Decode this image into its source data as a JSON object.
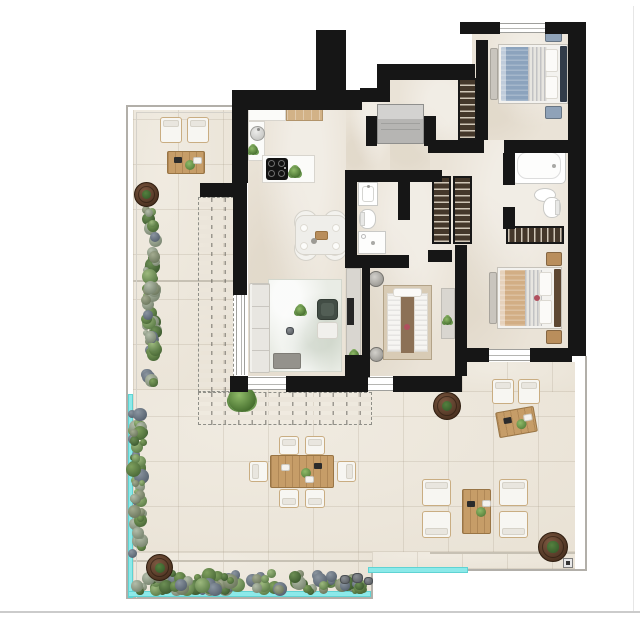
{
  "meta": {
    "type": "architectural-floor-plan",
    "description": "Rendered top-view floor plan of a three-bedroom apartment with two bathrooms, open kitchen-living area, wrap-around west and south terrace with pergola, hedges, planters, outdoor dining and lounge furniture, and a glass balustrade."
  },
  "palette": {
    "wall": "#161616",
    "interior_floor": "#eae3d7",
    "terrace_floor": "#ece6da",
    "glass_balustrade": "#8ce9e9",
    "wood": "#c69d68",
    "hedge_green": "#6d8f55",
    "planter_brown": "#5d4028",
    "duvet_blue": "#8ca3bd",
    "duvet_tan": "#d2ae85",
    "property_line": "#b2afa9"
  },
  "scene": [
    {
      "n": "terrace-floor-west",
      "t": "tfloor",
      "x": 133,
      "y": 110,
      "w": 100,
      "h": 280
    },
    {
      "n": "terrace-floor-south",
      "t": "tfloor",
      "x": 133,
      "y": 390,
      "w": 442,
      "h": 162
    },
    {
      "n": "terrace-floor-south-deep",
      "t": "tfloor",
      "x": 133,
      "y": 552,
      "w": 239,
      "h": 46
    },
    {
      "n": "terrace-floor-south-right",
      "t": "tfloor",
      "x": 372,
      "y": 552,
      "w": 203,
      "h": 17
    },
    {
      "n": "terrace-floor-east-gap",
      "t": "tfloor",
      "x": 462,
      "y": 362,
      "w": 113,
      "h": 30
    },
    {
      "n": "floor-kitchen-living",
      "t": "ifloor",
      "x": 248,
      "y": 92,
      "w": 98,
      "h": 284
    },
    {
      "n": "floor-hall-west",
      "t": "ifloor",
      "x": 346,
      "y": 100,
      "w": 44,
      "h": 76
    },
    {
      "n": "floor-hall-east",
      "t": "ifloor",
      "x": 390,
      "y": 80,
      "w": 86,
      "h": 96
    },
    {
      "n": "floor-bedroom1",
      "t": "ifloor",
      "x": 472,
      "y": 33,
      "w": 98,
      "h": 107
    },
    {
      "n": "floor-east-wing",
      "t": "ifloor",
      "x": 430,
      "y": 140,
      "w": 140,
      "h": 216
    },
    {
      "n": "floor-center-wing",
      "t": "ifloor",
      "x": 345,
      "y": 170,
      "w": 110,
      "h": 206
    },
    {
      "n": "floor-joint",
      "t": "jline",
      "x": 133,
      "y": 280,
      "w": 100,
      "h": 2
    },
    {
      "n": "floor-joint",
      "t": "jline",
      "x": 133,
      "y": 560,
      "w": 239,
      "h": 2
    },
    {
      "n": "floor-joint",
      "t": "jline",
      "x": 430,
      "y": 552,
      "w": 145,
      "h": 2
    },
    {
      "n": "pergola-west",
      "t": "pergola",
      "x": 198,
      "y": 197,
      "w": 36,
      "h": 195
    },
    {
      "n": "pergola-south",
      "t": "pergola",
      "x": 198,
      "y": 392,
      "w": 174,
      "h": 33
    },
    {
      "n": "grass-tuft",
      "t": "plant",
      "x": 228,
      "y": 386,
      "w": 28,
      "h": 26
    },
    {
      "n": "property-line-west",
      "t": "pline",
      "x": 126,
      "y": 105,
      "w": 2,
      "h": 494
    },
    {
      "n": "property-line-north",
      "t": "pline",
      "x": 126,
      "y": 105,
      "w": 107,
      "h": 2
    },
    {
      "n": "property-line-south",
      "t": "pline",
      "x": 126,
      "y": 597,
      "w": 246,
      "h": 2
    },
    {
      "n": "property-line-step",
      "t": "pline",
      "x": 371,
      "y": 569,
      "w": 2,
      "h": 30
    },
    {
      "n": "property-line-south-right",
      "t": "pline",
      "x": 371,
      "y": 569,
      "w": 216,
      "h": 2
    },
    {
      "n": "property-line-east",
      "t": "pline",
      "x": 585,
      "y": 356,
      "w": 2,
      "h": 215
    },
    {
      "n": "property-line-inner-west",
      "t": "pline4",
      "x": 136,
      "y": 112,
      "w": 1,
      "h": 486
    },
    {
      "n": "property-line-inner-north",
      "t": "pline4",
      "x": 136,
      "y": 112,
      "w": 97,
      "h": 1
    },
    {
      "n": "site-line-bottom",
      "t": "pline2",
      "x": 0,
      "y": 611,
      "w": 640,
      "h": 2
    },
    {
      "n": "site-line-right",
      "t": "pline3",
      "x": 633,
      "y": 6,
      "w": 1,
      "h": 605
    },
    {
      "n": "glass-balustrade-west",
      "t": "glass",
      "x": 128,
      "y": 394,
      "w": 5,
      "h": 204
    },
    {
      "n": "glass-balustrade-south",
      "t": "glass",
      "x": 128,
      "y": 591,
      "w": 243,
      "h": 6
    },
    {
      "n": "glass-balustrade-south-right",
      "t": "glass",
      "x": 368,
      "y": 567,
      "w": 100,
      "h": 6
    },
    {
      "n": "survey-marker",
      "t": "marker",
      "x": 563,
      "y": 558,
      "w": 10,
      "h": 10
    },
    {
      "n": "hedge-west-upper",
      "t": "hedge",
      "x": 143,
      "y": 206,
      "w": 17,
      "h": 184
    },
    {
      "n": "hedge-west-lower",
      "t": "hedge",
      "x": 129,
      "y": 410,
      "w": 17,
      "h": 148
    },
    {
      "n": "hedge-south",
      "t": "hedge",
      "x": 133,
      "y": 571,
      "w": 238,
      "h": 23
    },
    {
      "n": "planter-nw",
      "t": "planter",
      "x": 134,
      "y": 182,
      "w": 25,
      "h": 25
    },
    {
      "n": "planter-center",
      "t": "planter",
      "x": 433,
      "y": 392,
      "w": 28,
      "h": 28
    },
    {
      "n": "planter-se",
      "t": "planter",
      "x": 538,
      "y": 532,
      "w": 30,
      "h": 30
    },
    {
      "n": "planter-sw",
      "t": "planter",
      "x": 146,
      "y": 554,
      "w": 27,
      "h": 27
    },
    {
      "n": "rock",
      "t": "rock",
      "x": 340,
      "y": 575,
      "w": 10,
      "h": 9
    },
    {
      "n": "rock",
      "t": "rock",
      "x": 352,
      "y": 573,
      "w": 11,
      "h": 10
    },
    {
      "n": "rock",
      "t": "rock",
      "x": 364,
      "y": 577,
      "w": 9,
      "h": 8
    },
    {
      "n": "lounge-chair",
      "t": "chairo",
      "x": 160,
      "y": 117,
      "w": 22,
      "h": 26,
      "b": "n"
    },
    {
      "n": "lounge-chair",
      "t": "chairo",
      "x": 187,
      "y": 117,
      "w": 22,
      "h": 26,
      "b": "n"
    },
    {
      "n": "coffee-table",
      "t": "twood",
      "x": 167,
      "y": 151,
      "w": 38,
      "h": 23,
      "d": [
        "trayb",
        "plant",
        "trayw"
      ]
    },
    {
      "n": "outdoor-dining-chair",
      "t": "chairo",
      "x": 279,
      "y": 436,
      "w": 20,
      "h": 19,
      "b": "n"
    },
    {
      "n": "outdoor-dining-chair",
      "t": "chairo",
      "x": 305,
      "y": 436,
      "w": 20,
      "h": 19,
      "b": "n"
    },
    {
      "n": "outdoor-dining-chair",
      "t": "chairo",
      "x": 279,
      "y": 489,
      "w": 20,
      "h": 19,
      "b": "s"
    },
    {
      "n": "outdoor-dining-chair",
      "t": "chairo",
      "x": 305,
      "y": 489,
      "w": 20,
      "h": 19,
      "b": "s"
    },
    {
      "n": "outdoor-dining-chair",
      "t": "chairo",
      "x": 249,
      "y": 461,
      "w": 19,
      "h": 21,
      "b": "w"
    },
    {
      "n": "outdoor-dining-chair",
      "t": "chairo",
      "x": 337,
      "y": 461,
      "w": 19,
      "h": 21,
      "b": "e"
    },
    {
      "n": "outdoor-dining-table",
      "t": "twood",
      "x": 270,
      "y": 455,
      "w": 64,
      "h": 33,
      "d": [
        "trayw",
        "plant",
        "trayb",
        "trayw2"
      ]
    },
    {
      "n": "lounge-armchair",
      "t": "chairo",
      "x": 422,
      "y": 479,
      "w": 29,
      "h": 27,
      "b": "n"
    },
    {
      "n": "lounge-armchair",
      "t": "chairo",
      "x": 499,
      "y": 479,
      "w": 29,
      "h": 27,
      "b": "n"
    },
    {
      "n": "lounge-armchair",
      "t": "chairo",
      "x": 422,
      "y": 511,
      "w": 29,
      "h": 27,
      "b": "s"
    },
    {
      "n": "lounge-armchair",
      "t": "chairo",
      "x": 499,
      "y": 511,
      "w": 29,
      "h": 27,
      "b": "s"
    },
    {
      "n": "lounge-coffee-table",
      "t": "twood",
      "x": 462,
      "y": 489,
      "w": 29,
      "h": 45,
      "d": [
        "trayb",
        "plant",
        "trayw"
      ]
    },
    {
      "n": "bistro-chair",
      "t": "chairo",
      "x": 492,
      "y": 379,
      "w": 22,
      "h": 25,
      "b": "n"
    },
    {
      "n": "bistro-chair",
      "t": "chairo",
      "x": 518,
      "y": 379,
      "w": 22,
      "h": 25,
      "b": "n"
    },
    {
      "n": "bistro-table",
      "t": "twood",
      "x": 497,
      "y": 409,
      "w": 39,
      "h": 26,
      "r": -10,
      "d": [
        "trayb",
        "plant",
        "trayw"
      ]
    },
    {
      "n": "kitchen-counter",
      "t": "counter",
      "x": 248,
      "y": 103,
      "w": 38,
      "h": 18
    },
    {
      "n": "kitchen-counter-wood",
      "t": "counterw",
      "x": 286,
      "y": 103,
      "w": 37,
      "h": 18
    },
    {
      "n": "kitchen-counter-side",
      "t": "counter",
      "x": 248,
      "y": 121,
      "w": 17,
      "h": 40
    },
    {
      "n": "kitchen-sink",
      "t": "sinkr",
      "x": 250,
      "y": 126,
      "w": 15,
      "h": 15
    },
    {
      "n": "kitchen-plant",
      "t": "plant",
      "x": 248,
      "y": 145,
      "w": 10,
      "h": 10
    },
    {
      "n": "kitchen-island",
      "t": "counter",
      "x": 262,
      "y": 155,
      "w": 53,
      "h": 28
    },
    {
      "n": "cooktop",
      "t": "hob",
      "x": 266,
      "y": 158,
      "w": 22,
      "h": 22
    },
    {
      "n": "island-plant",
      "t": "plant",
      "x": 289,
      "y": 166,
      "w": 12,
      "h": 12
    },
    {
      "n": "dining-chair",
      "t": "chairr",
      "x": 294,
      "y": 210,
      "w": 24,
      "h": 24
    },
    {
      "n": "dining-chair",
      "t": "chairr",
      "x": 323,
      "y": 210,
      "w": 24,
      "h": 24
    },
    {
      "n": "dining-chair",
      "t": "chairr",
      "x": 294,
      "y": 237,
      "w": 24,
      "h": 24
    },
    {
      "n": "dining-chair",
      "t": "chairr",
      "x": 323,
      "y": 237,
      "w": 24,
      "h": 24
    },
    {
      "n": "dining-table",
      "t": "tablein",
      "x": 295,
      "y": 215,
      "w": 52,
      "h": 40
    },
    {
      "n": "area-rug",
      "t": "rug",
      "x": 268,
      "y": 279,
      "w": 74,
      "h": 93
    },
    {
      "n": "sofa",
      "t": "sofa",
      "x": 249,
      "y": 283,
      "w": 21,
      "h": 90
    },
    {
      "n": "ottoman",
      "t": "ottoman",
      "x": 273,
      "y": 353,
      "w": 28,
      "h": 16
    },
    {
      "n": "armchair",
      "t": "chairdark",
      "x": 317,
      "y": 299,
      "w": 21,
      "h": 21
    },
    {
      "n": "side-table",
      "t": "sidetable",
      "x": 317,
      "y": 322,
      "w": 21,
      "h": 17
    },
    {
      "n": "rug-plant",
      "t": "plant",
      "x": 295,
      "y": 305,
      "w": 11,
      "h": 11
    },
    {
      "n": "rug-deco",
      "t": "rock",
      "x": 286,
      "y": 327,
      "w": 8,
      "h": 8
    },
    {
      "n": "tv-console",
      "t": "console",
      "x": 346,
      "y": 268,
      "w": 15,
      "h": 106
    },
    {
      "n": "tv",
      "t": "tv",
      "x": 347,
      "y": 298,
      "w": 7,
      "h": 27
    },
    {
      "n": "console-plant",
      "t": "plant",
      "x": 349,
      "y": 350,
      "w": 10,
      "h": 10
    },
    {
      "n": "washbasin",
      "t": "vanity",
      "x": 358,
      "y": 182,
      "w": 20,
      "h": 24
    },
    {
      "n": "toilet",
      "t": "toilet",
      "x": 359,
      "y": 209,
      "w": 17,
      "h": 20,
      "o": "w"
    },
    {
      "n": "shower",
      "t": "shower",
      "x": 358,
      "y": 231,
      "w": 28,
      "h": 23
    },
    {
      "n": "bedside-stool",
      "t": "stool",
      "x": 368,
      "y": 271,
      "w": 16,
      "h": 16
    },
    {
      "n": "bedside-stool",
      "t": "stool",
      "x": 369,
      "y": 347,
      "w": 15,
      "h": 15
    },
    {
      "n": "bed-bedroom3",
      "t": "bed3",
      "x": 383,
      "y": 285,
      "w": 49,
      "h": 75
    },
    {
      "n": "dresser",
      "t": "console",
      "x": 441,
      "y": 288,
      "w": 14,
      "h": 51
    },
    {
      "n": "dresser-plant",
      "t": "plant",
      "x": 443,
      "y": 316,
      "w": 9,
      "h": 9
    },
    {
      "n": "decor-accent",
      "t": "dotred",
      "x": 404,
      "y": 324,
      "w": 6,
      "h": 6
    },
    {
      "n": "foot-bench",
      "t": "bench",
      "x": 490,
      "y": 48,
      "w": 8,
      "h": 52
    },
    {
      "n": "bed-bedroom1",
      "t": "bed",
      "x": 498,
      "y": 44,
      "w": 70,
      "h": 60,
      "dv": "#8ca3bd",
      "hb": "#323c49"
    },
    {
      "n": "nightstand",
      "t": "nstand",
      "x": 545,
      "y": 29,
      "w": 17,
      "h": 13,
      "c": "#8fa2b8"
    },
    {
      "n": "nightstand",
      "t": "nstand",
      "x": 545,
      "y": 106,
      "w": 17,
      "h": 13,
      "c": "#8fa2b8"
    },
    {
      "n": "wardrobe-hall",
      "t": "wardrobe",
      "x": 458,
      "y": 78,
      "w": 19,
      "h": 62,
      "o": "v"
    },
    {
      "n": "wardrobe-corridor",
      "t": "wardrobe",
      "x": 432,
      "y": 176,
      "w": 19,
      "h": 68,
      "o": "v"
    },
    {
      "n": "wardrobe-corridor",
      "t": "wardrobe",
      "x": 453,
      "y": 176,
      "w": 19,
      "h": 68,
      "o": "v"
    },
    {
      "n": "bathtub",
      "t": "tub",
      "x": 512,
      "y": 147,
      "w": 54,
      "h": 37
    },
    {
      "n": "basin",
      "t": "sinko",
      "x": 534,
      "y": 188,
      "w": 22,
      "h": 14
    },
    {
      "n": "toilet",
      "t": "toilet",
      "x": 543,
      "y": 197,
      "w": 18,
      "h": 21,
      "o": "e"
    },
    {
      "n": "wardrobe-bedroom2",
      "t": "wardrobe",
      "x": 506,
      "y": 226,
      "w": 58,
      "h": 18,
      "o": "h"
    },
    {
      "n": "foot-bench",
      "t": "bench",
      "x": 489,
      "y": 272,
      "w": 8,
      "h": 52
    },
    {
      "n": "bed-bedroom2",
      "t": "bed",
      "x": 497,
      "y": 267,
      "w": 65,
      "h": 62,
      "dv": "#d2ae85",
      "hb": "#5d4732"
    },
    {
      "n": "nightstand",
      "t": "nstand",
      "x": 546,
      "y": 252,
      "w": 16,
      "h": 14,
      "c": "#b98e5c"
    },
    {
      "n": "nightstand",
      "t": "nstand",
      "x": 546,
      "y": 330,
      "w": 16,
      "h": 14,
      "c": "#b98e5c"
    },
    {
      "n": "decor-accent",
      "t": "dotred",
      "x": 534,
      "y": 295,
      "w": 6,
      "h": 6
    },
    {
      "n": "entrance-mat",
      "t": "mat",
      "x": 377,
      "y": 104,
      "w": 47,
      "h": 40
    },
    {
      "n": "wall-chimney",
      "t": "wall",
      "x": 316,
      "y": 30,
      "w": 30,
      "h": 80
    },
    {
      "n": "wall",
      "t": "wall",
      "x": 232,
      "y": 90,
      "w": 130,
      "h": 20
    },
    {
      "n": "wall",
      "t": "wall",
      "x": 232,
      "y": 90,
      "w": 16,
      "h": 93
    },
    {
      "n": "wall",
      "t": "wall",
      "x": 200,
      "y": 183,
      "w": 47,
      "h": 14
    },
    {
      "n": "wall",
      "t": "wall",
      "x": 233,
      "y": 193,
      "w": 14,
      "h": 102
    },
    {
      "n": "wall",
      "t": "wall",
      "x": 230,
      "y": 376,
      "w": 18,
      "h": 16
    },
    {
      "n": "wall",
      "t": "wall",
      "x": 286,
      "y": 376,
      "w": 58,
      "h": 16
    },
    {
      "n": "wall",
      "t": "wall",
      "x": 342,
      "y": 376,
      "w": 26,
      "h": 16
    },
    {
      "n": "wall",
      "t": "wall",
      "x": 393,
      "y": 376,
      "w": 69,
      "h": 16
    },
    {
      "n": "wall",
      "t": "wall",
      "x": 360,
      "y": 88,
      "w": 29,
      "h": 14
    },
    {
      "n": "wall",
      "t": "wall",
      "x": 377,
      "y": 64,
      "w": 13,
      "h": 38
    },
    {
      "n": "wall",
      "t": "wall",
      "x": 384,
      "y": 64,
      "w": 91,
      "h": 16
    },
    {
      "n": "wall",
      "t": "wall",
      "x": 366,
      "y": 116,
      "w": 11,
      "h": 30
    },
    {
      "n": "wall",
      "t": "wall",
      "x": 424,
      "y": 116,
      "w": 12,
      "h": 30
    },
    {
      "n": "wall",
      "t": "wall",
      "x": 460,
      "y": 22,
      "w": 40,
      "h": 12
    },
    {
      "n": "wall",
      "t": "wall",
      "x": 545,
      "y": 22,
      "w": 41,
      "h": 12
    },
    {
      "n": "wall",
      "t": "wall",
      "x": 476,
      "y": 40,
      "w": 12,
      "h": 100
    },
    {
      "n": "wall",
      "t": "wall",
      "x": 568,
      "y": 24,
      "w": 18,
      "h": 332
    },
    {
      "n": "wall",
      "t": "wall",
      "x": 428,
      "y": 140,
      "w": 56,
      "h": 13
    },
    {
      "n": "wall",
      "t": "wall",
      "x": 504,
      "y": 140,
      "w": 66,
      "h": 13
    },
    {
      "n": "wall",
      "t": "wall",
      "x": 503,
      "y": 153,
      "w": 12,
      "h": 32
    },
    {
      "n": "wall",
      "t": "wall",
      "x": 503,
      "y": 207,
      "w": 12,
      "h": 22
    },
    {
      "n": "wall",
      "t": "wall",
      "x": 345,
      "y": 170,
      "w": 97,
      "h": 12
    },
    {
      "n": "wall",
      "t": "wall",
      "x": 345,
      "y": 170,
      "w": 12,
      "h": 97
    },
    {
      "n": "wall",
      "t": "wall",
      "x": 398,
      "y": 182,
      "w": 12,
      "h": 38
    },
    {
      "n": "wall",
      "t": "wall",
      "x": 345,
      "y": 255,
      "w": 64,
      "h": 13
    },
    {
      "n": "wall",
      "t": "wall",
      "x": 428,
      "y": 250,
      "w": 24,
      "h": 12
    },
    {
      "n": "wall",
      "t": "wall",
      "x": 455,
      "y": 245,
      "w": 12,
      "h": 131
    },
    {
      "n": "wall",
      "t": "wall",
      "x": 467,
      "y": 348,
      "w": 22,
      "h": 14
    },
    {
      "n": "wall",
      "t": "wall",
      "x": 530,
      "y": 348,
      "w": 42,
      "h": 14
    },
    {
      "n": "wall",
      "t": "wall",
      "x": 362,
      "y": 262,
      "w": 8,
      "h": 118
    },
    {
      "n": "wall",
      "t": "wall",
      "x": 345,
      "y": 355,
      "w": 17,
      "h": 21
    },
    {
      "n": "window-bedroom1",
      "t": "winh",
      "x": 500,
      "y": 23,
      "w": 45,
      "h": 10
    },
    {
      "n": "window-bedroom2",
      "t": "winh",
      "x": 489,
      "y": 349,
      "w": 41,
      "h": 12
    },
    {
      "n": "window-bedroom3",
      "t": "winh",
      "x": 368,
      "y": 377,
      "w": 25,
      "h": 14
    },
    {
      "n": "sliding-door-living",
      "t": "winh",
      "x": 248,
      "y": 377,
      "w": 38,
      "h": 13
    },
    {
      "n": "glass-door-west",
      "t": "winv",
      "x": 236,
      "y": 295,
      "w": 9,
      "h": 80
    }
  ]
}
